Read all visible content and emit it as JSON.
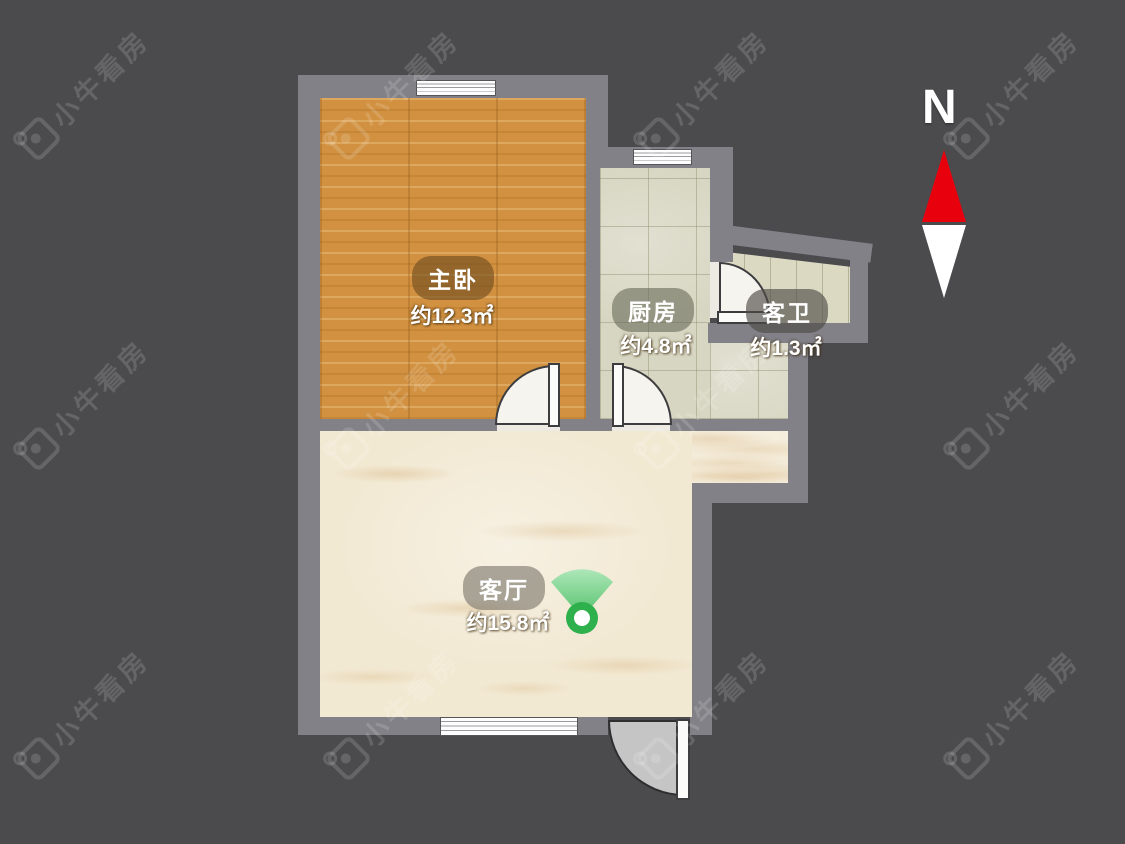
{
  "watermark": {
    "text": "小牛看房",
    "icon": "niu-logo-icon"
  },
  "compass": {
    "label": "N",
    "north_color": "#e8000d"
  },
  "rooms": {
    "bedroom": {
      "label": "主卧",
      "area": "约12.3㎡",
      "floor": "wood"
    },
    "kitchen": {
      "label": "厨房",
      "area": "约4.8㎡",
      "floor": "tile"
    },
    "bathroom": {
      "label": "客卫",
      "area": "约1.3㎡",
      "floor": "tile"
    },
    "living": {
      "label": "客厅",
      "area": "约15.8㎡",
      "floor": "marble"
    }
  },
  "icons": {
    "vr_point": "panorama-fan-icon"
  },
  "colors": {
    "background": "#4b4b4e",
    "wall": "#818187",
    "wood_floor": "#d19140",
    "tile_floor": "#d7d6c2",
    "marble_floor": "#f2e9d3",
    "vr_green": "#2eb04c",
    "label_text": "#ffffff"
  }
}
